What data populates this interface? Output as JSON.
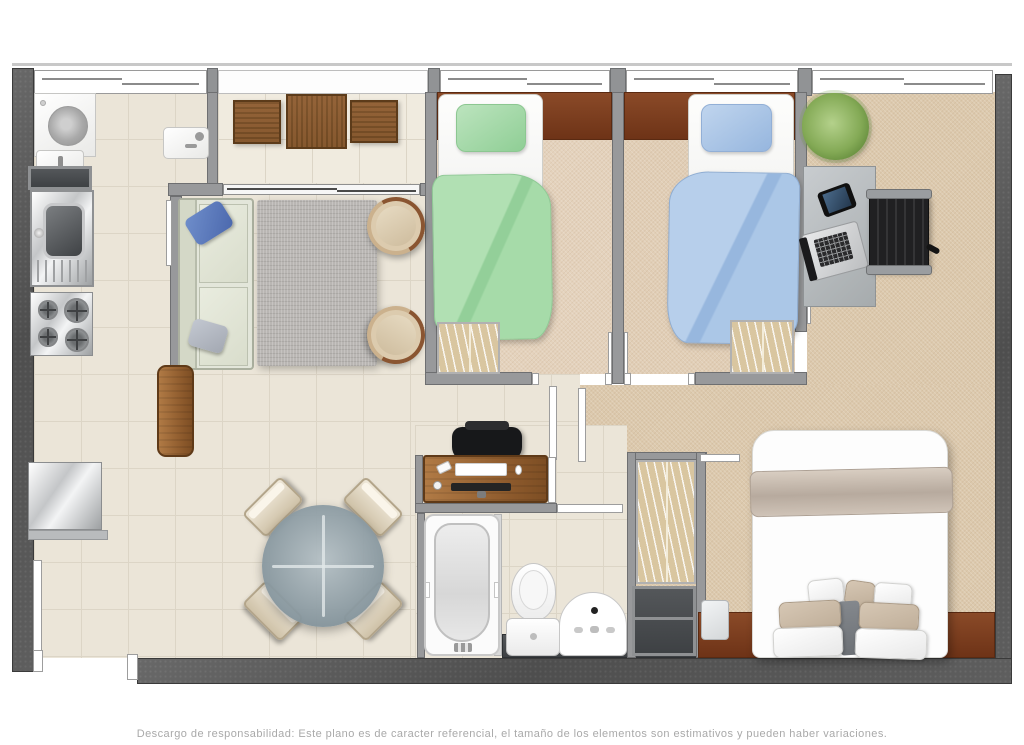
{
  "disclaimer": "Descargo de responsabilidad: Este plano es de caracter referencial, el tamaño de los elementos son estimativos y pueden haber variaciones.",
  "palette": {
    "wall-outer": "#585858",
    "wall-inner": "#98999b",
    "tile": "#ebe5d8",
    "carpet": "#dcc9ad",
    "wood": "#7a3b1e",
    "bed-green": "#a5dba8",
    "bed-blue": "#a9c6e6",
    "sofa": "#e3e6da",
    "text-muted": "#a9a9a9"
  },
  "plan": {
    "type": "apartment-floor-plan",
    "rooms": [
      "laundry",
      "kitchen",
      "balcony",
      "living-room",
      "dining-area",
      "bedroom-1",
      "bedroom-2",
      "office-area",
      "master-bedroom",
      "bathroom",
      "hallway"
    ],
    "furniture_icons": [
      "washing-machine-icon",
      "laundry-sink-icon",
      "kitchen-sink-icon",
      "stove-icon",
      "refrigerator-icon",
      "wood-door-icon",
      "sofa-icon",
      "rug-icon",
      "armchair-icon",
      "balcony-table-icon",
      "balcony-chair-icon",
      "single-bed-green-icon",
      "single-bed-blue-icon",
      "wardrobe-icon",
      "desk-icon",
      "office-chair-icon",
      "laptop-icon",
      "tablet-icon",
      "plant-icon",
      "dining-table-icon",
      "dining-chair-icon",
      "bathtub-icon",
      "toilet-icon",
      "washbasin-icon",
      "double-bed-icon",
      "nightstand-icon"
    ]
  }
}
